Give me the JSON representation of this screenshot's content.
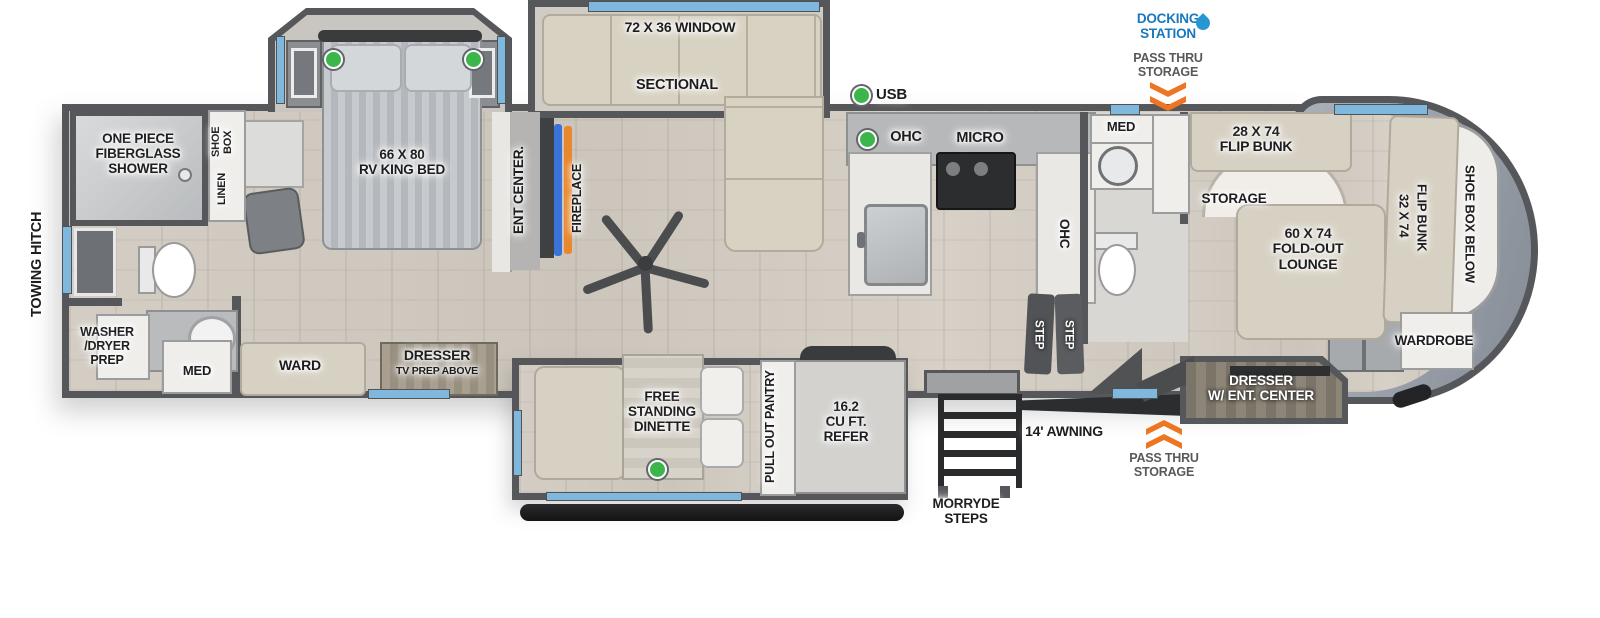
{
  "exterior": {
    "towing_hitch": "TOWING HITCH",
    "docking_station": "DOCKING\nSTATION",
    "pass_thru_storage_top": "PASS THRU\nSTORAGE",
    "pass_thru_storage_bottom": "PASS THRU\nSTORAGE",
    "awning": "14' AWNING",
    "morryde_steps": "MORRYDE\nSTEPS",
    "usb": "USB"
  },
  "front_bath": {
    "shower": "ONE PIECE\nFIBERGLASS\nSHOWER",
    "washer_dryer": "WASHER\n/DRYER\nPREP",
    "med": "MED",
    "shoe_box": "SHOE\nBOX",
    "linen": "LINEN"
  },
  "bedroom": {
    "bed": "66 X 80\nRV KING BED",
    "ward": "WARD",
    "dresser": "DRESSER",
    "tv_prep": "TV PREP ABOVE",
    "ent_center": "ENT CENTER.",
    "fireplace": "FIREPLACE"
  },
  "living": {
    "window": "72 X 36 WINDOW",
    "sectional": "SECTIONAL"
  },
  "kitchen": {
    "ohc": "OHC",
    "micro": "MICRO",
    "ohc_side": "OHC",
    "steps": [
      "STEP",
      "STEP"
    ]
  },
  "dinette_slide": {
    "dinette": "FREE\nSTANDING\nDINETTE",
    "pantry": "PULL OUT PANTRY",
    "refer": "16.2\nCU FT.\nREFER"
  },
  "mid_bath": {
    "med": "MED"
  },
  "bunk_room": {
    "flip_bunk_28": "28 X 74\nFLIP BUNK",
    "storage": "STORAGE",
    "lounge": "60 X 74\nFOLD-OUT\nLOUNGE",
    "flip_bunk_32": [
      "32 X 74",
      "FLIP BUNK"
    ],
    "shoe_box_below": "SHOE BOX BELOW",
    "wardrobe": "WARDROBE",
    "dresser_ent_center": "DRESSER\nW/ ENT. CENTER"
  },
  "colors": {
    "wall": "#55575a",
    "floor": "#d0cac1",
    "window_blue": "#7fb8dc",
    "indicator_green": "#3cb54a",
    "arrow_orange": "#ee7623",
    "docking_blue": "#1878be",
    "furniture_beige": "#d7d1c3",
    "cap_gray": "#9aa1ab",
    "fireplace_orange": "#e8872e",
    "tv_blue": "#3b72d9"
  }
}
